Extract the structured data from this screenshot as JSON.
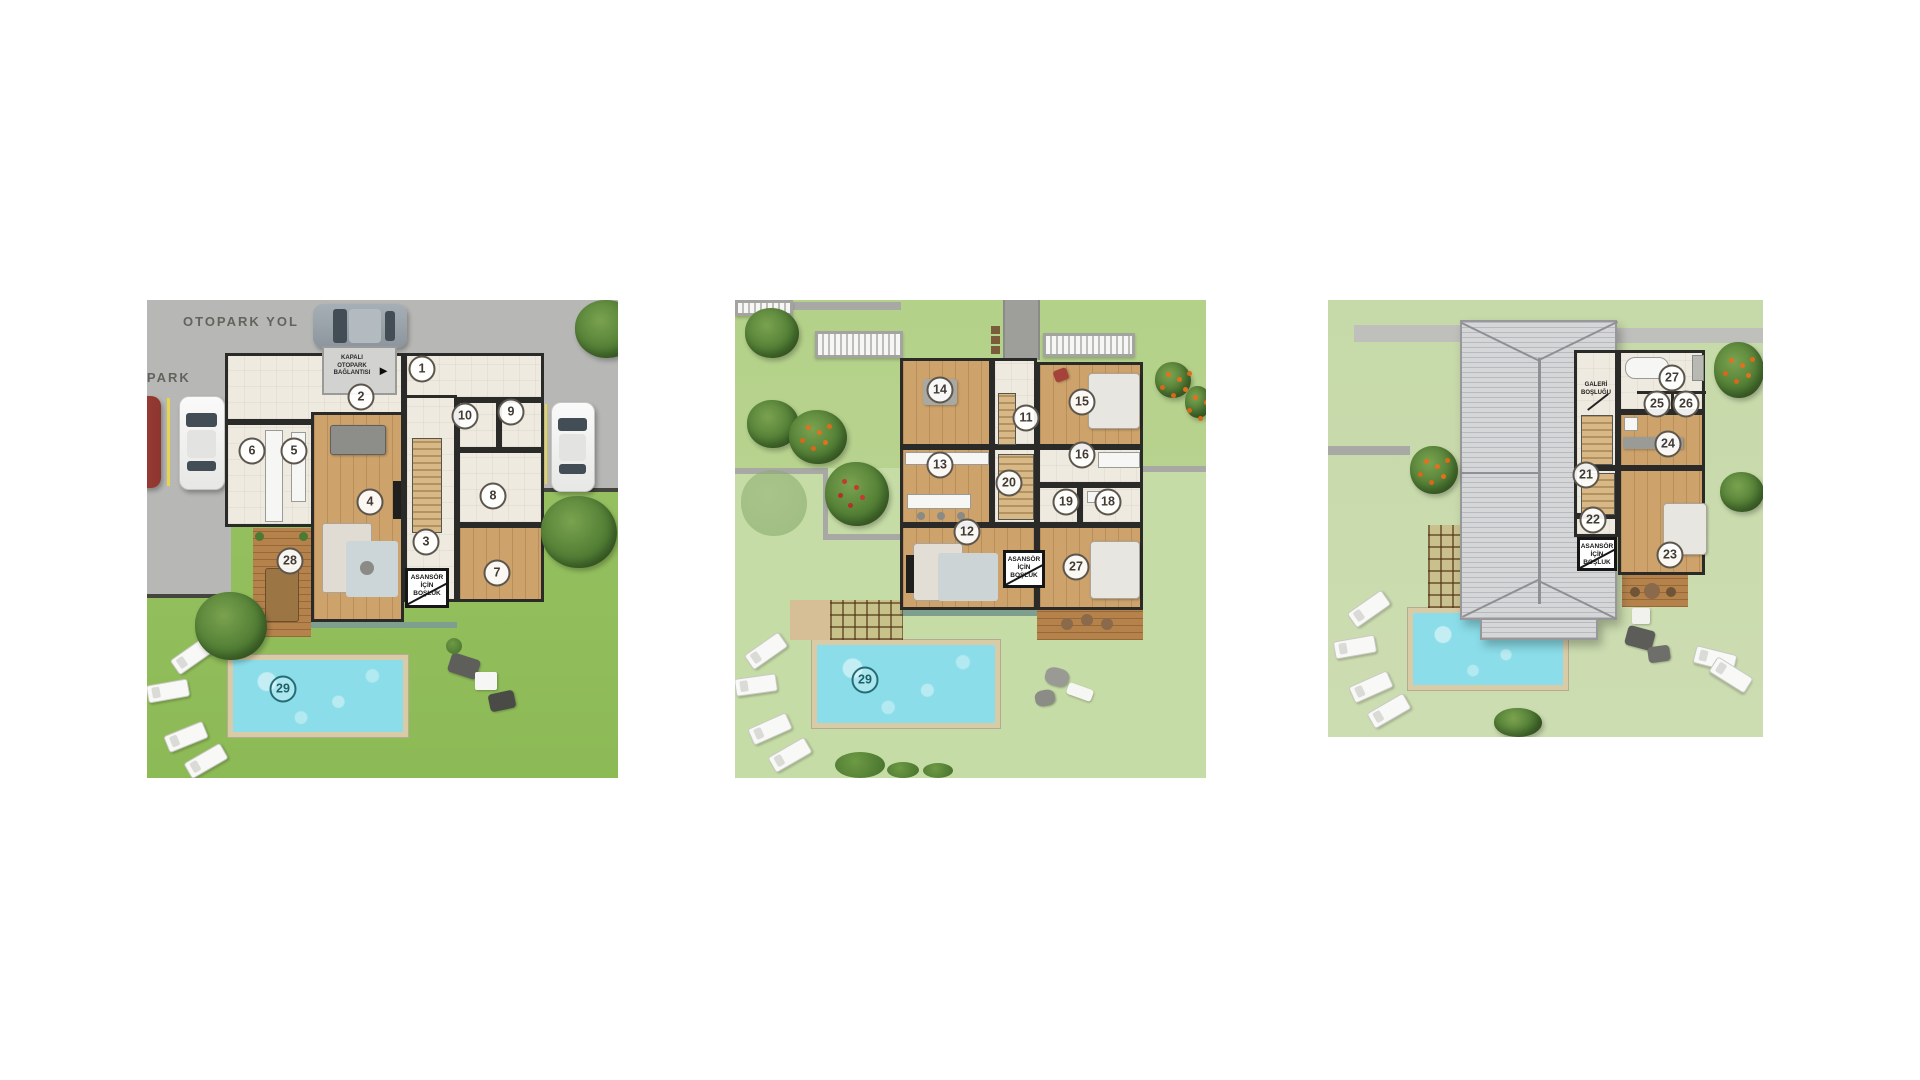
{
  "colors": {
    "page_bg": "#ffffff",
    "grass_ground": "#96c262",
    "grass_first": "#b9d491",
    "grass_roof": "#c8daab",
    "road_gray": "#b7b7b5",
    "wall_dark": "#2a2a28",
    "floor_cream": "#efeae0",
    "floor_wood": "#cda26b",
    "pool_water": "#8adde9",
    "pool_edge": "#d9cba6",
    "roof_gray": "#d4d6d8",
    "badge_ring": "#5d564d",
    "pool_badge_ring": "#256d75"
  },
  "plans": {
    "ground": {
      "road_label": "OTOPARK YOL",
      "parking_label": "OTOPARK",
      "garage_link_label": "KAPALI OTOPARK BAĞLANTISI",
      "garage_link_arrow": "►",
      "elevator_void_label": "ASANSÖR İÇİN BOŞLUK",
      "rooms": {
        "r1": "1",
        "r2": "2",
        "r3": "3",
        "r4": "4",
        "r5": "5",
        "r6": "6",
        "r7": "7",
        "r8": "8",
        "r9": "9",
        "r10": "10",
        "r28": "28",
        "r29": "29"
      }
    },
    "first": {
      "elevator_void_label": "ASANSÖR İÇİN BOŞLUK",
      "rooms": {
        "r11": "11",
        "r12": "12",
        "r13": "13",
        "r14": "14",
        "r15": "15",
        "r16": "16",
        "r18": "18",
        "r19": "19",
        "r20": "20",
        "r27": "27",
        "r29": "29"
      }
    },
    "roof": {
      "gallery_void_label": "GALERİ BOŞLUĞU",
      "elevator_void_label": "ASANSÖR İÇİN BOŞLUK",
      "rooms": {
        "r21": "21",
        "r22": "22",
        "r23": "23",
        "r24": "24",
        "r25": "25",
        "r26": "26",
        "r27": "27"
      }
    }
  }
}
